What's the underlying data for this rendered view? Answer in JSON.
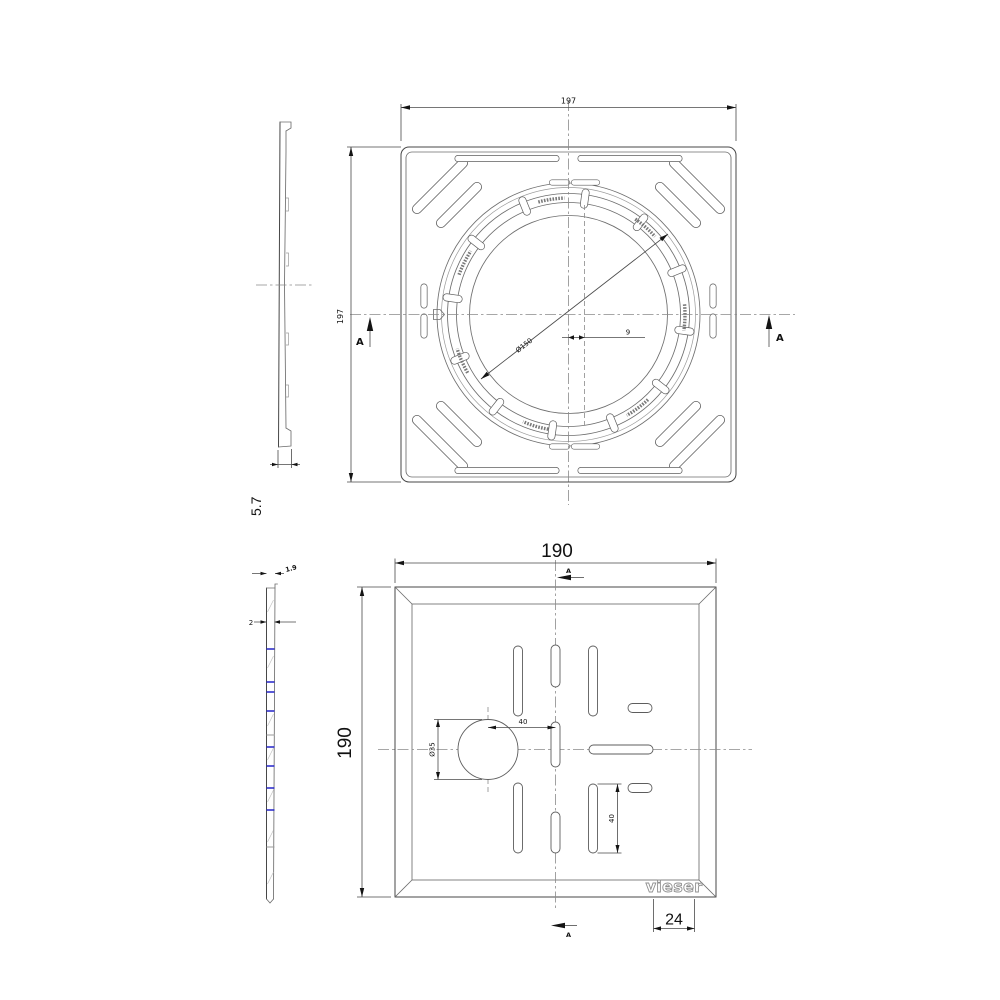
{
  "drawing": {
    "colors": {
      "background": "#ffffff",
      "lines": "#4a4a4a",
      "accent_blue": "#2323c8"
    },
    "views": {
      "frame_side_profile": {
        "thickness": "5.7"
      },
      "frame_top": {
        "width": "197",
        "height": "197",
        "ring_diameter": "Ø150",
        "section_offset": "9",
        "section_label_left": "A",
        "section_label_right": "A"
      },
      "lid_side_profile": {
        "edge_thickness": "1.9",
        "plate_thickness": "2"
      },
      "lid_top": {
        "width": "190",
        "height": "190",
        "hole_diameter": "Ø35",
        "hole_offset": "40",
        "slot_length": "40",
        "logo_offset": "24",
        "section_label_top": "A",
        "section_label_bottom": "A",
        "logo": "vieser"
      }
    }
  }
}
